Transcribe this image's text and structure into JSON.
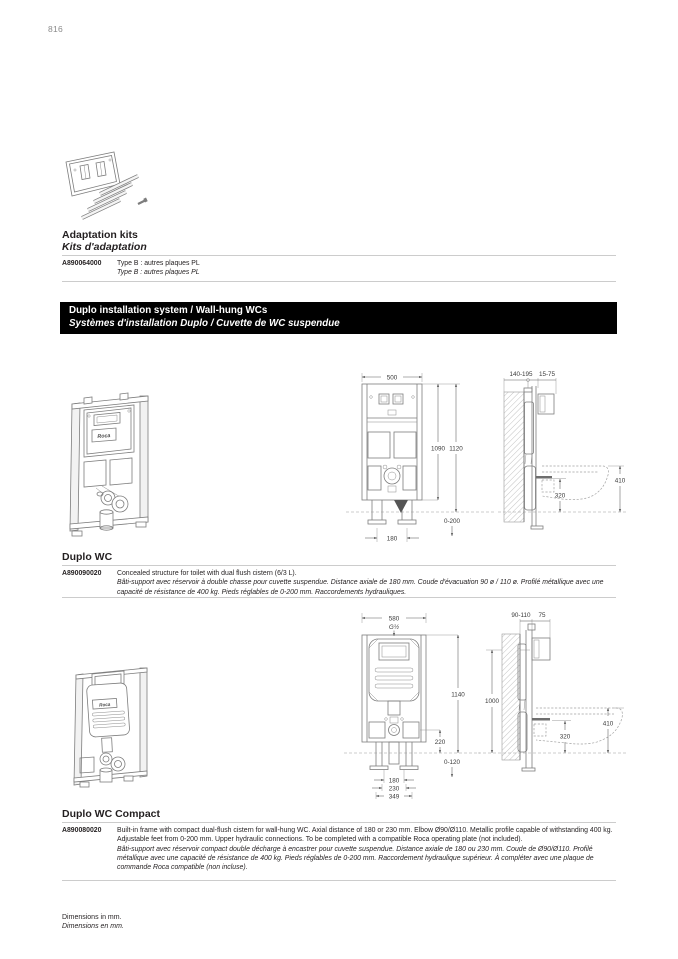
{
  "page": {
    "number": "816",
    "footer_en": "Dimensions in mm.",
    "footer_fr": "Dimensions en mm."
  },
  "colors": {
    "banner_bg": "#000000",
    "banner_text": "#ffffff",
    "rule": "#cccccc",
    "drawing_line": "#7d7d7d"
  },
  "brand": "Roca",
  "adaptation": {
    "title_en": "Adaptation kits",
    "title_fr": "Kits d'adaptation",
    "rows": [
      {
        "code": "A890064000",
        "desc_en": "Type B : autres plaques PL",
        "desc_fr": "Type B : autres plaques PL"
      }
    ]
  },
  "banner": {
    "title_en": "Duplo installation system / Wall-hung WCs",
    "title_fr": "Systèmes d'installation Duplo / Cuvette de WC suspendue"
  },
  "duplo_wc": {
    "title": "Duplo WC",
    "code": "A890090020",
    "desc_en": "Concealed structure for toilet with dual flush cistern (6/3 L).",
    "desc_fr": "Bâti-support avec réservoir à double chasse pour cuvette suspendue. Distance axiale de 180 mm. Coude d'évacuation 90 ø / 110 ø. Profilé métallique avec une capacité de résistance de 400 kg. Pieds réglables de 0-200 mm. Raccordements hydrauliques.",
    "front": {
      "width": "500",
      "h_inner": "1090",
      "h_outer": "1120",
      "feet": "0-200",
      "axial": "180"
    },
    "side": {
      "depth_wall": "140-195",
      "depth_plate": "15-75",
      "outlet_h": "320",
      "bowl_h": "410"
    }
  },
  "duplo_compact": {
    "title": "Duplo WC Compact",
    "code": "A890080020",
    "desc_en": "Built-in frame with compact dual-flush cistern for wall-hung WC. Axial distance of 180 or 230 mm. Elbow Ø90/Ø110. Metallic profile capable of withstanding 400 kg. Adjustable feet from 0-200 mm. Upper hydraulic connections. To be completed with a compatible Roca operating plate (not included).",
    "desc_fr": "Bâti-support avec réservoir compact double décharge à encastrer pour cuvette suspendue. Distance axiale de 180 ou 230 mm. Coude de Ø90/Ø110. Profilé métallique avec une capacité de résistance de 400 kg.  Pieds réglables de 0-200 mm. Raccordement hydraulique supérieur. À compléter avec une plaque de commande Roca compatible (non incluse).",
    "front": {
      "width": "580",
      "connection": "G½",
      "h_outer": "1140",
      "outlet_drop": "220",
      "feet": "0-120",
      "axial_1": "180",
      "axial_2": "230",
      "base": "349"
    },
    "side": {
      "depth_wall": "90-110",
      "depth_plate": "75",
      "conn_h": "1000",
      "outlet_h": "320",
      "bowl_h": "410"
    }
  }
}
